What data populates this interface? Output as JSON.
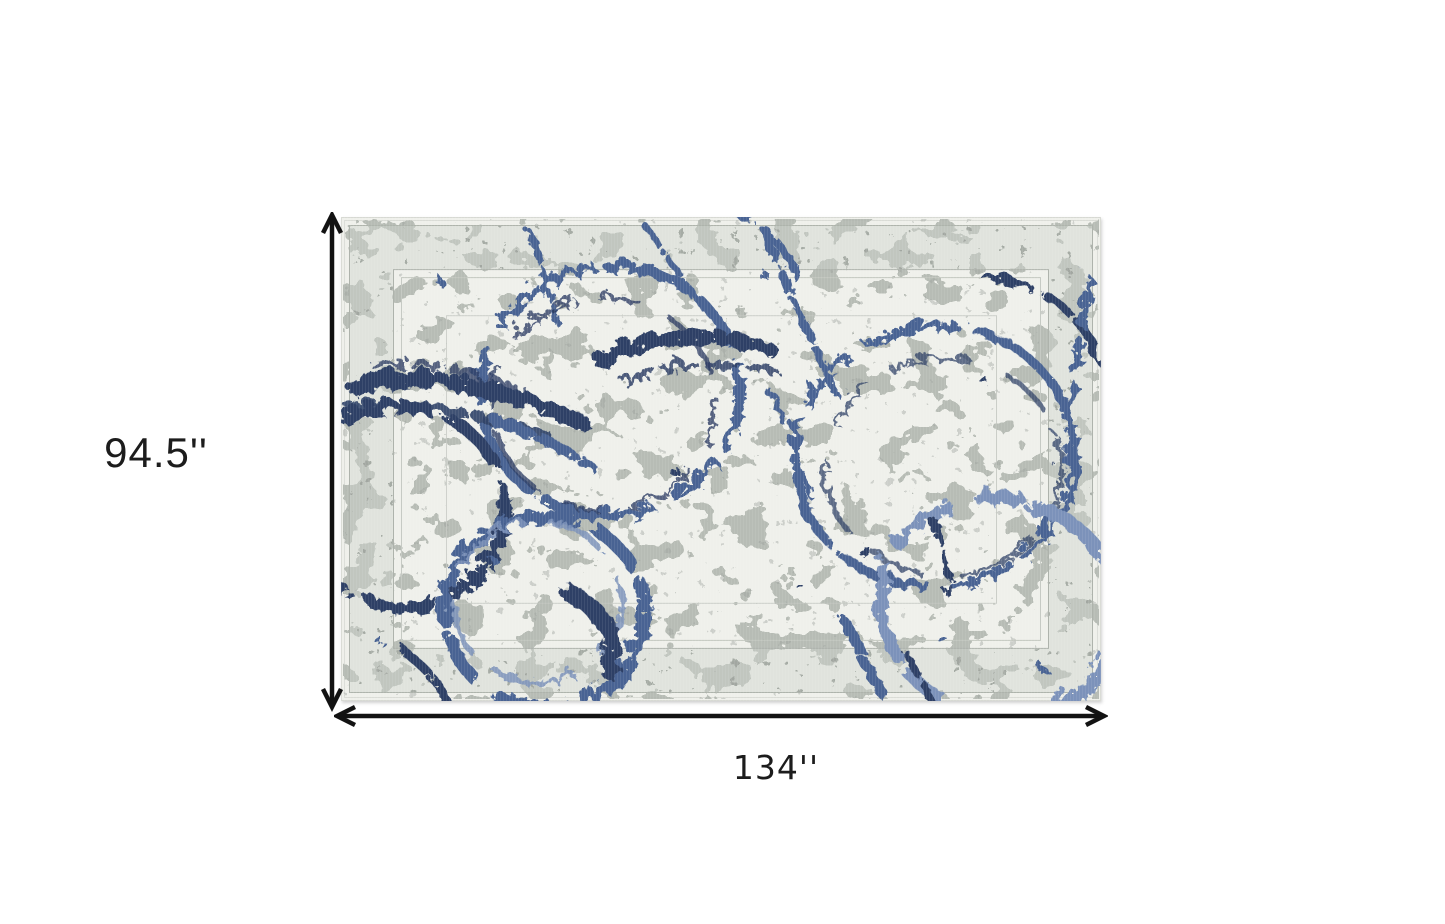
{
  "diagram": {
    "height_label": "94.5''",
    "width_label": "134''",
    "rug_description": "Distressed cream and gray oriental area rug overlaid with abstract blue paint rings and splatter"
  },
  "colors": {
    "arrow": "#121212",
    "label_text": "#1c1c1c",
    "rug_base": "#eff0eb",
    "rug_gray": "#aeb3ac",
    "rug_border_gray": "#cfd2cc",
    "blue_dark": "#2e4066",
    "blue_mid": "#4a6493",
    "blue_light": "#7b92ba"
  }
}
